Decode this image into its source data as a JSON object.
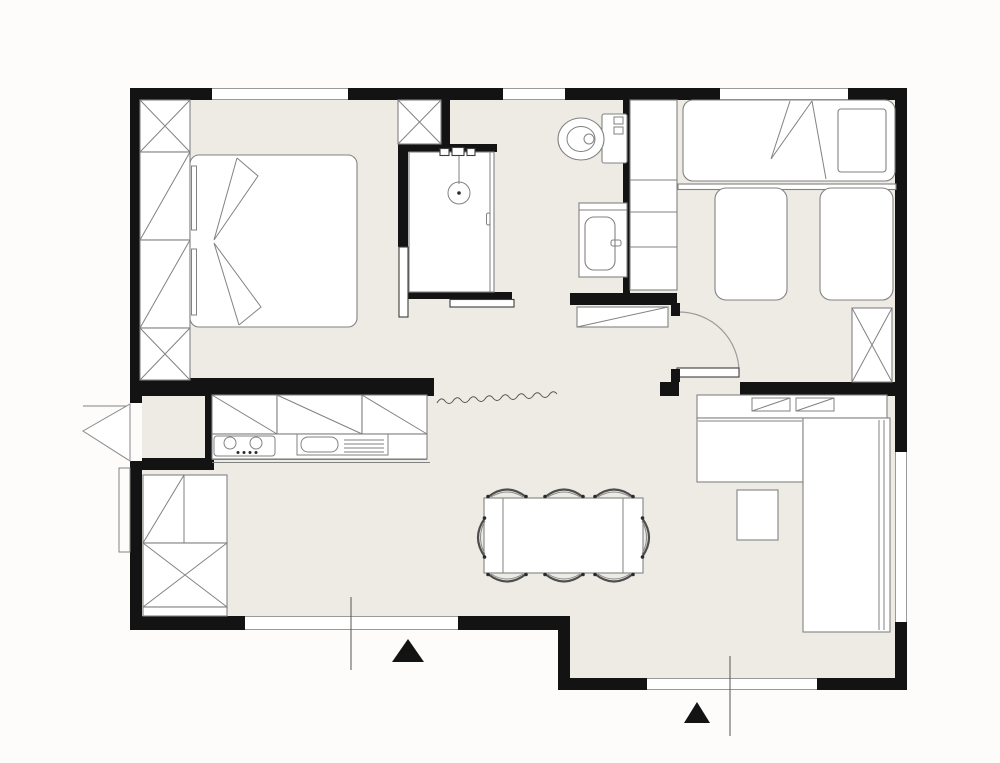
{
  "page": {
    "title": "apartment-floor-plan",
    "visible_text_labels": []
  },
  "colors": {
    "background": "#fdfcfa",
    "floor": "#edebe4",
    "wall": "#131313",
    "furniture_line": "#828282",
    "entrance_marker": "#131313"
  },
  "plan": {
    "type": "architectural-floor-plan-top-view",
    "rooms": [
      {
        "name": "master-bedroom",
        "fixtures": [
          "double-bed",
          "wardrobe-column-4-sections",
          "top-window"
        ]
      },
      {
        "name": "shower-room",
        "fixtures": [
          "walk-in-shower",
          "shower-head",
          "sliding-door"
        ]
      },
      {
        "name": "toilet-area",
        "fixtures": [
          "toilet",
          "washbasin-vanity"
        ]
      },
      {
        "name": "hallway",
        "fixtures": [
          "shoe-bench",
          "hinged-door",
          "wall-break-squiggle"
        ]
      },
      {
        "name": "kids-bedroom",
        "fixtures": [
          "single-bed",
          "floor-mattress",
          "floor-mattress",
          "shelf-column",
          "wardrobe-x-box",
          "top-window",
          "side-window"
        ]
      },
      {
        "name": "kitchen",
        "fixtures": [
          "upper-cabinets-3",
          "cooktop-2-burners",
          "sink-with-drainer",
          "pantry-cabinets",
          "entry-vestibule"
        ]
      },
      {
        "name": "living-dining",
        "fixtures": [
          "dining-table",
          "chairs-x8",
          "l-shaped-sofa",
          "coffee-table",
          "sideboard-with-drawers",
          "south-window",
          "south-east-window"
        ]
      }
    ],
    "doors": [
      "west-entry-door-triangle",
      "kids-room-hinged-door",
      "shower-sliding-door"
    ],
    "annotations": [
      "section-line-south-west",
      "section-line-south-east",
      "entrance-triangle-south-west",
      "entrance-triangle-south-east"
    ],
    "counts": {
      "dining_chairs": 8,
      "windows": 6,
      "wardrobe_x_boxes": 5
    }
  }
}
